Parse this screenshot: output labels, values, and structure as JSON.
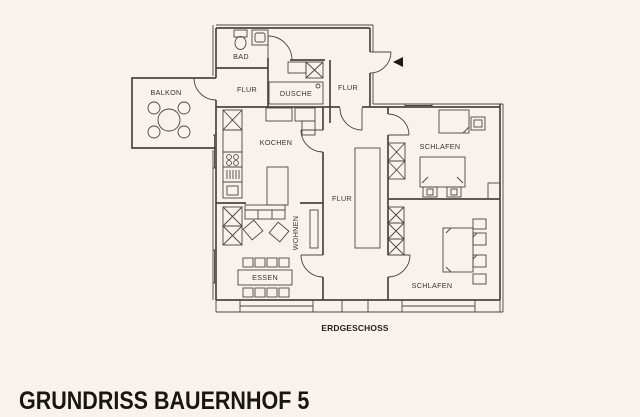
{
  "title": "GRUNDRISS BAUERNHOF 5",
  "caption": "ERDGESCHOSS",
  "colors": {
    "background": "#f9f2ec",
    "line": "#4c453e",
    "label_text": "#39332d",
    "title_text": "#191511",
    "entrance_arrow": "#1d1915"
  },
  "rooms": {
    "bad": "BAD",
    "balkon": "BALKON",
    "flur_top": "FLUR",
    "flur_entry": "FLUR",
    "dusche": "DUSCHE",
    "kochen": "KOCHEN",
    "flur_center": "FLUR",
    "wohnen": "WOHNEN",
    "essen": "ESSEN",
    "schlafen_top": "SCHLAFEN",
    "schlafen_bottom": "SCHLAFEN"
  },
  "icons": {
    "entrance_arrow": "left-filled-triangle",
    "wardrobe_symbol": "crossed-box",
    "stove_symbol": "four-burner-circles",
    "balcony_table_symbol": "round-table-four-chairs"
  }
}
